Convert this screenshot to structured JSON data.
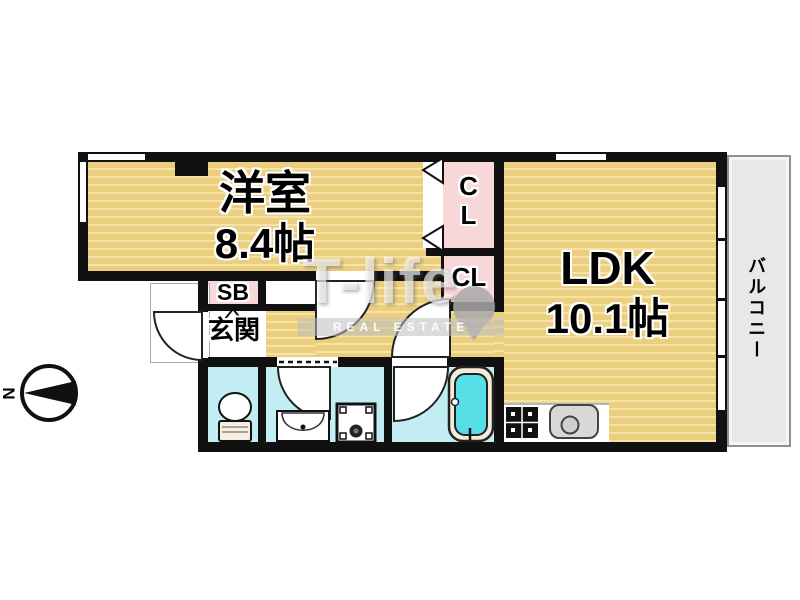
{
  "plan": {
    "title": "1LDK apartment floor plan",
    "rooms": {
      "western_room": {
        "name": "洋室",
        "area": "8.4帖"
      },
      "ldk": {
        "name": "LDK",
        "area": "10.1帖"
      },
      "closet_upper": {
        "line1": "C",
        "line2": "L"
      },
      "closet_lower": {
        "label": "CL"
      },
      "shoe_box": {
        "label": "SB"
      },
      "entrance": {
        "label": "玄関"
      },
      "balcony": {
        "label": "バルコニー"
      }
    },
    "fixtures": [
      "toilet-icon",
      "washbasin-icon",
      "washing-machine-pan-icon",
      "bathtub-icon",
      "stove-icon",
      "kitchen-sink-icon",
      "door-swing-icon",
      "folding-closet-door-icon"
    ],
    "compass": {
      "label": "N",
      "direction": "north-left"
    },
    "watermark": {
      "brand": "T-life",
      "tagline": "REAL ESTATE"
    },
    "colors": {
      "floor_tan": "#ebce7e",
      "floor_stripe": "#f5e4a8",
      "closet_pink": "#f8d7d9",
      "wet_area_cyan": "#c2eef3",
      "bathtub_cyan": "#57dfe8",
      "balcony_gray": "#e8e8e8",
      "wall_black": "#111111",
      "background": "#ffffff"
    }
  }
}
